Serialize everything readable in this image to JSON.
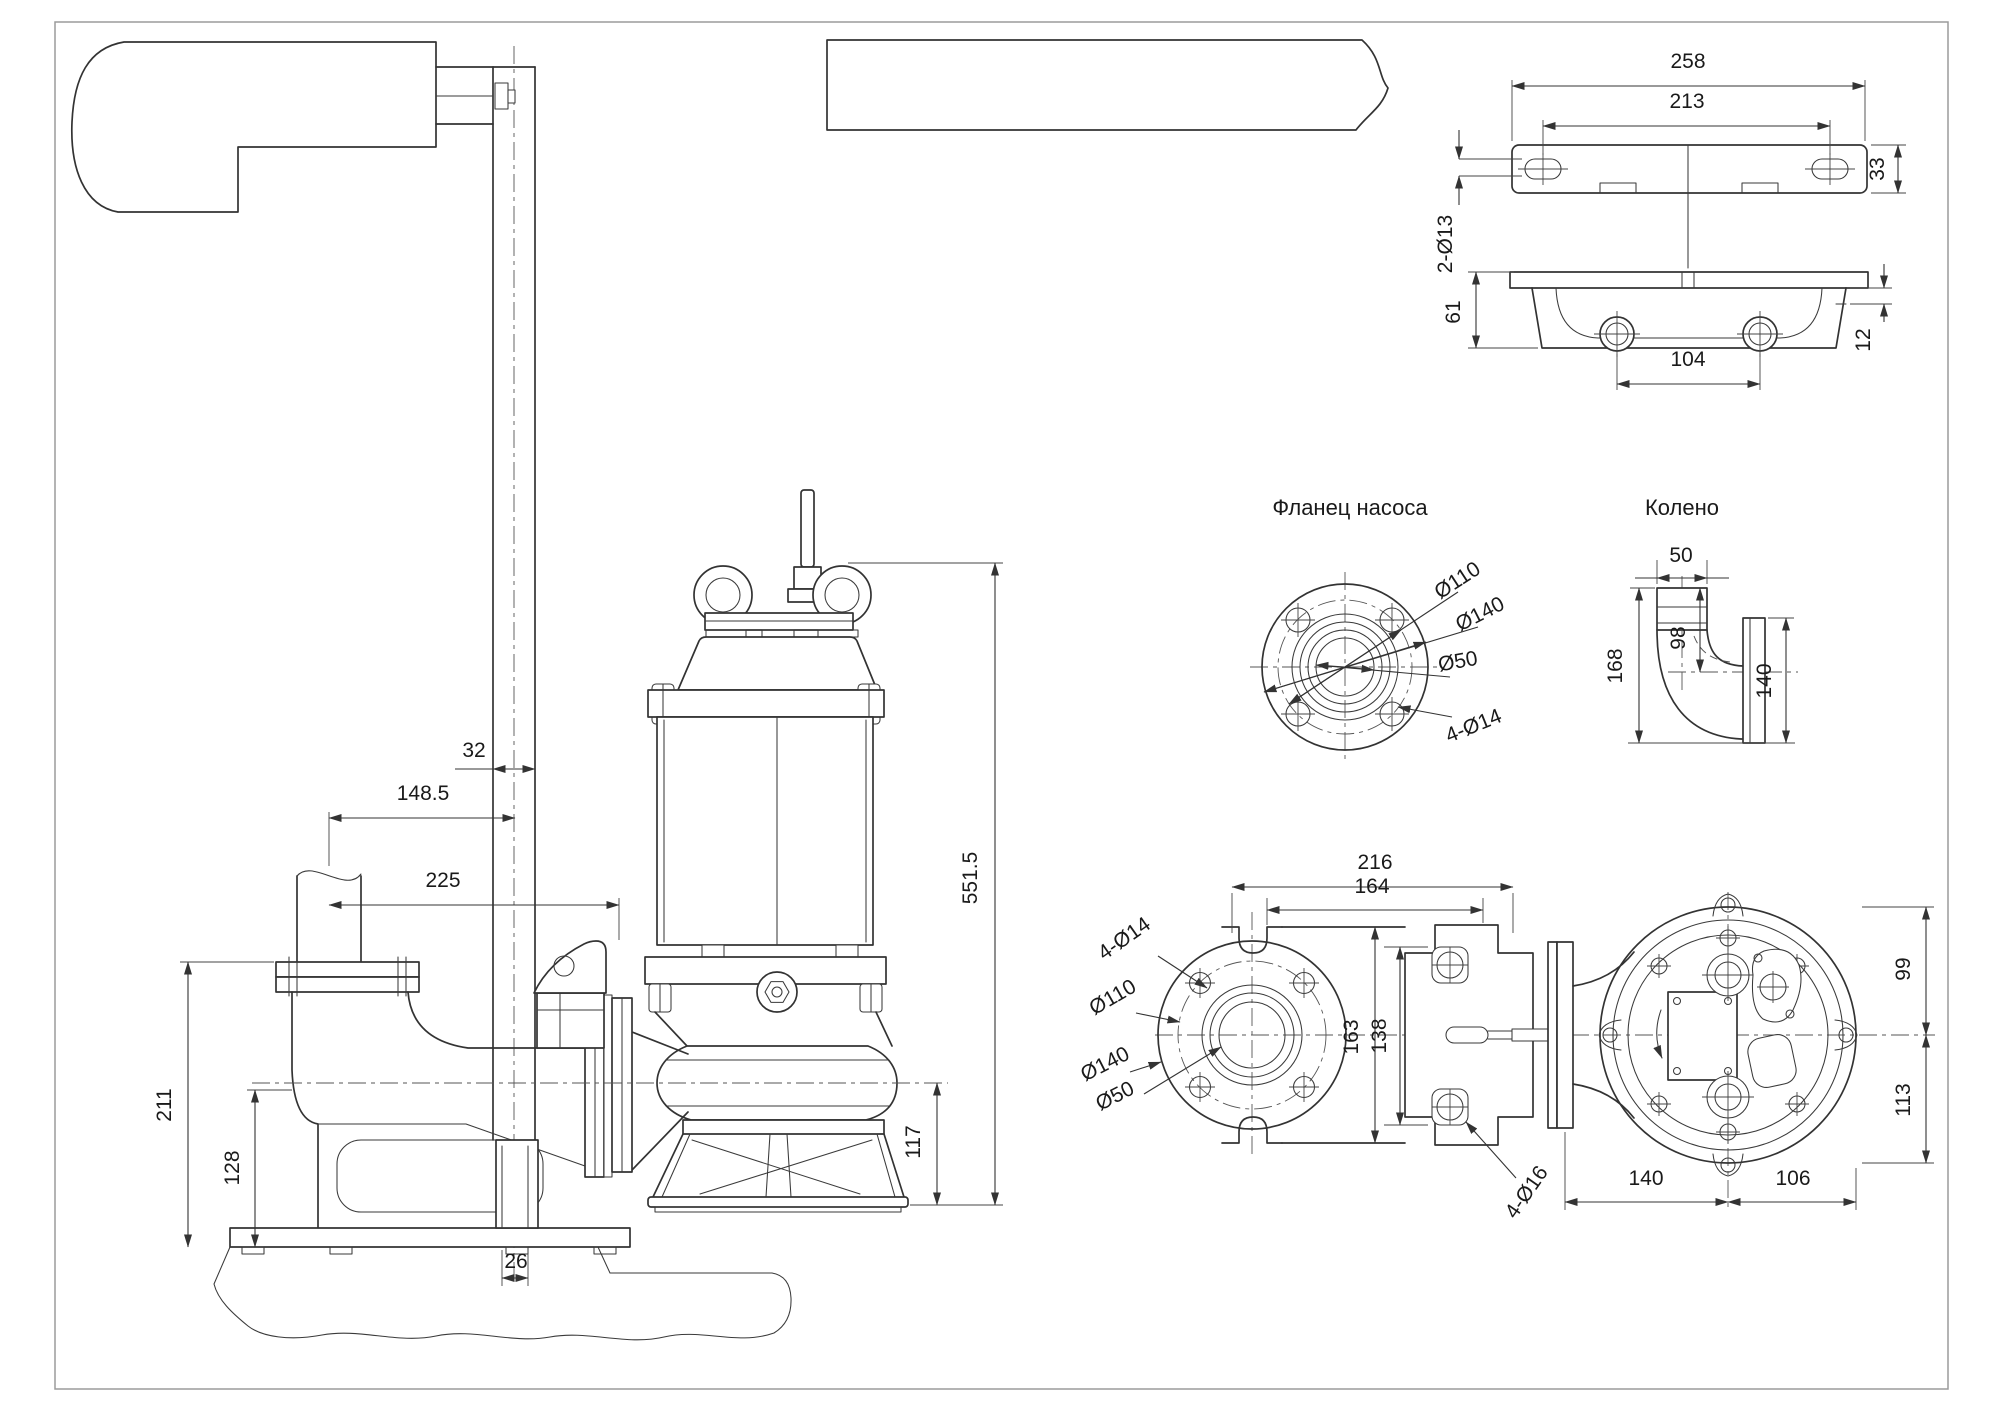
{
  "titles": {
    "pump_flange": "Фланец насоса",
    "elbow": "Колено"
  },
  "side": {
    "rail_width": "32",
    "pipe_to_rail": "148.5",
    "pipe_to_flange": "225",
    "outlet_height": "211",
    "base_height": "128",
    "rail_slot": "26",
    "axis_to_base": "117",
    "pump_height": "551.5"
  },
  "bracket": {
    "overall": "258",
    "slots": "213",
    "depth": "33",
    "slot_holes": "2-Ø13",
    "body_height": "61",
    "plate": "12",
    "bosses": "104"
  },
  "flange": {
    "bolt_circle": "Ø110",
    "outer": "Ø140",
    "bore": "Ø50",
    "holes": "4-Ø14"
  },
  "elbow": {
    "inlet": "50",
    "axis": "98",
    "height": "168",
    "flange": "140"
  },
  "top": {
    "overall": "216",
    "flange_adapter": "164",
    "flange_h": "163",
    "adapter_h": "138",
    "front": "99",
    "back": "113",
    "left": "140",
    "right": "106",
    "adapter_holes": "4-Ø16",
    "holes": "4-Ø14",
    "bolt_circle": "Ø110",
    "outer": "Ø140",
    "bore": "Ø50"
  }
}
